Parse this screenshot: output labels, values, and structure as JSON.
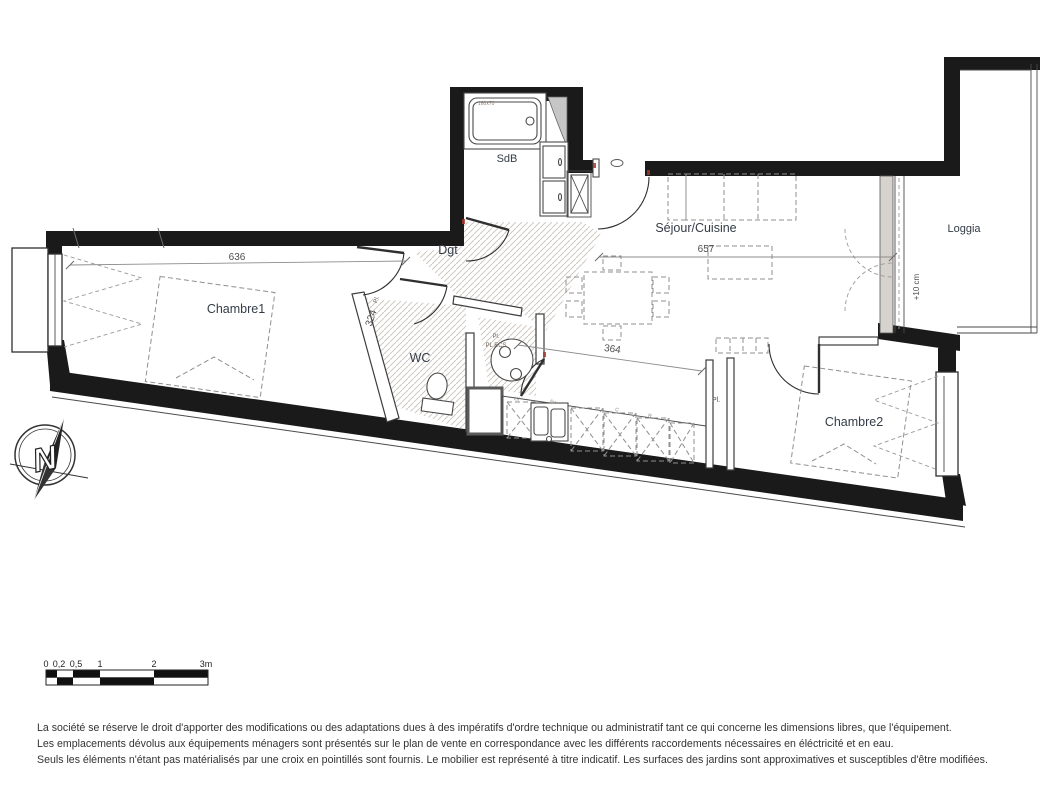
{
  "colors": {
    "wall": "#1a1a1a",
    "room_label": "#333c47",
    "dim": "#4e4e4e",
    "hatch": "#cfc9c3",
    "dash": "#8f8f8f",
    "accent_red": "#a63a2e"
  },
  "rooms": {
    "sdb": "SdB",
    "dgt": "Dgt",
    "sejour": "Séjour/Cuisine",
    "loggia": "Loggia",
    "chambre1": "Chambre1",
    "wc": "WC",
    "chambre2": "Chambre2"
  },
  "dimensions": {
    "chambre1_width": "636",
    "sejour_width": "657",
    "kitchen_width": "364",
    "hall_depth": "324",
    "loggia_step": "+10 cm"
  },
  "fixtures": {
    "closet_hall": "Pl.",
    "closet_ecs_small": "Pl.",
    "closet_ecs": "PL ECS",
    "closet_chambre2": "Pl.",
    "dishwasher": "LV",
    "sink": "Ev",
    "cooker": "C",
    "fridge": "R",
    "bathtub_size": "160x70"
  },
  "compass": {
    "north": "N"
  },
  "scale_bar": {
    "labels": [
      "0",
      "0,2",
      "0,5",
      "1",
      "2",
      "3m"
    ]
  },
  "disclaimer": {
    "line1": "La société se réserve le droit  d'apporter des modifications ou des adaptations dues à des impératifs d'ordre technique ou administratif tant ce qui concerne les dimensions libres, que l'équipement.",
    "line2": "Les emplacements dévolus aux équipements ménagers sont présentés sur le plan de vente en correspondance avec les différents raccordements nécessaires en éléctricité et en eau.",
    "line3": "Seuls les éléments n'étant pas matérialisés par une croix en pointillés sont fournis. Le mobilier est représenté à titre indicatif. Les surfaces des jardins sont approximatives et susceptibles d'être modifiées."
  }
}
